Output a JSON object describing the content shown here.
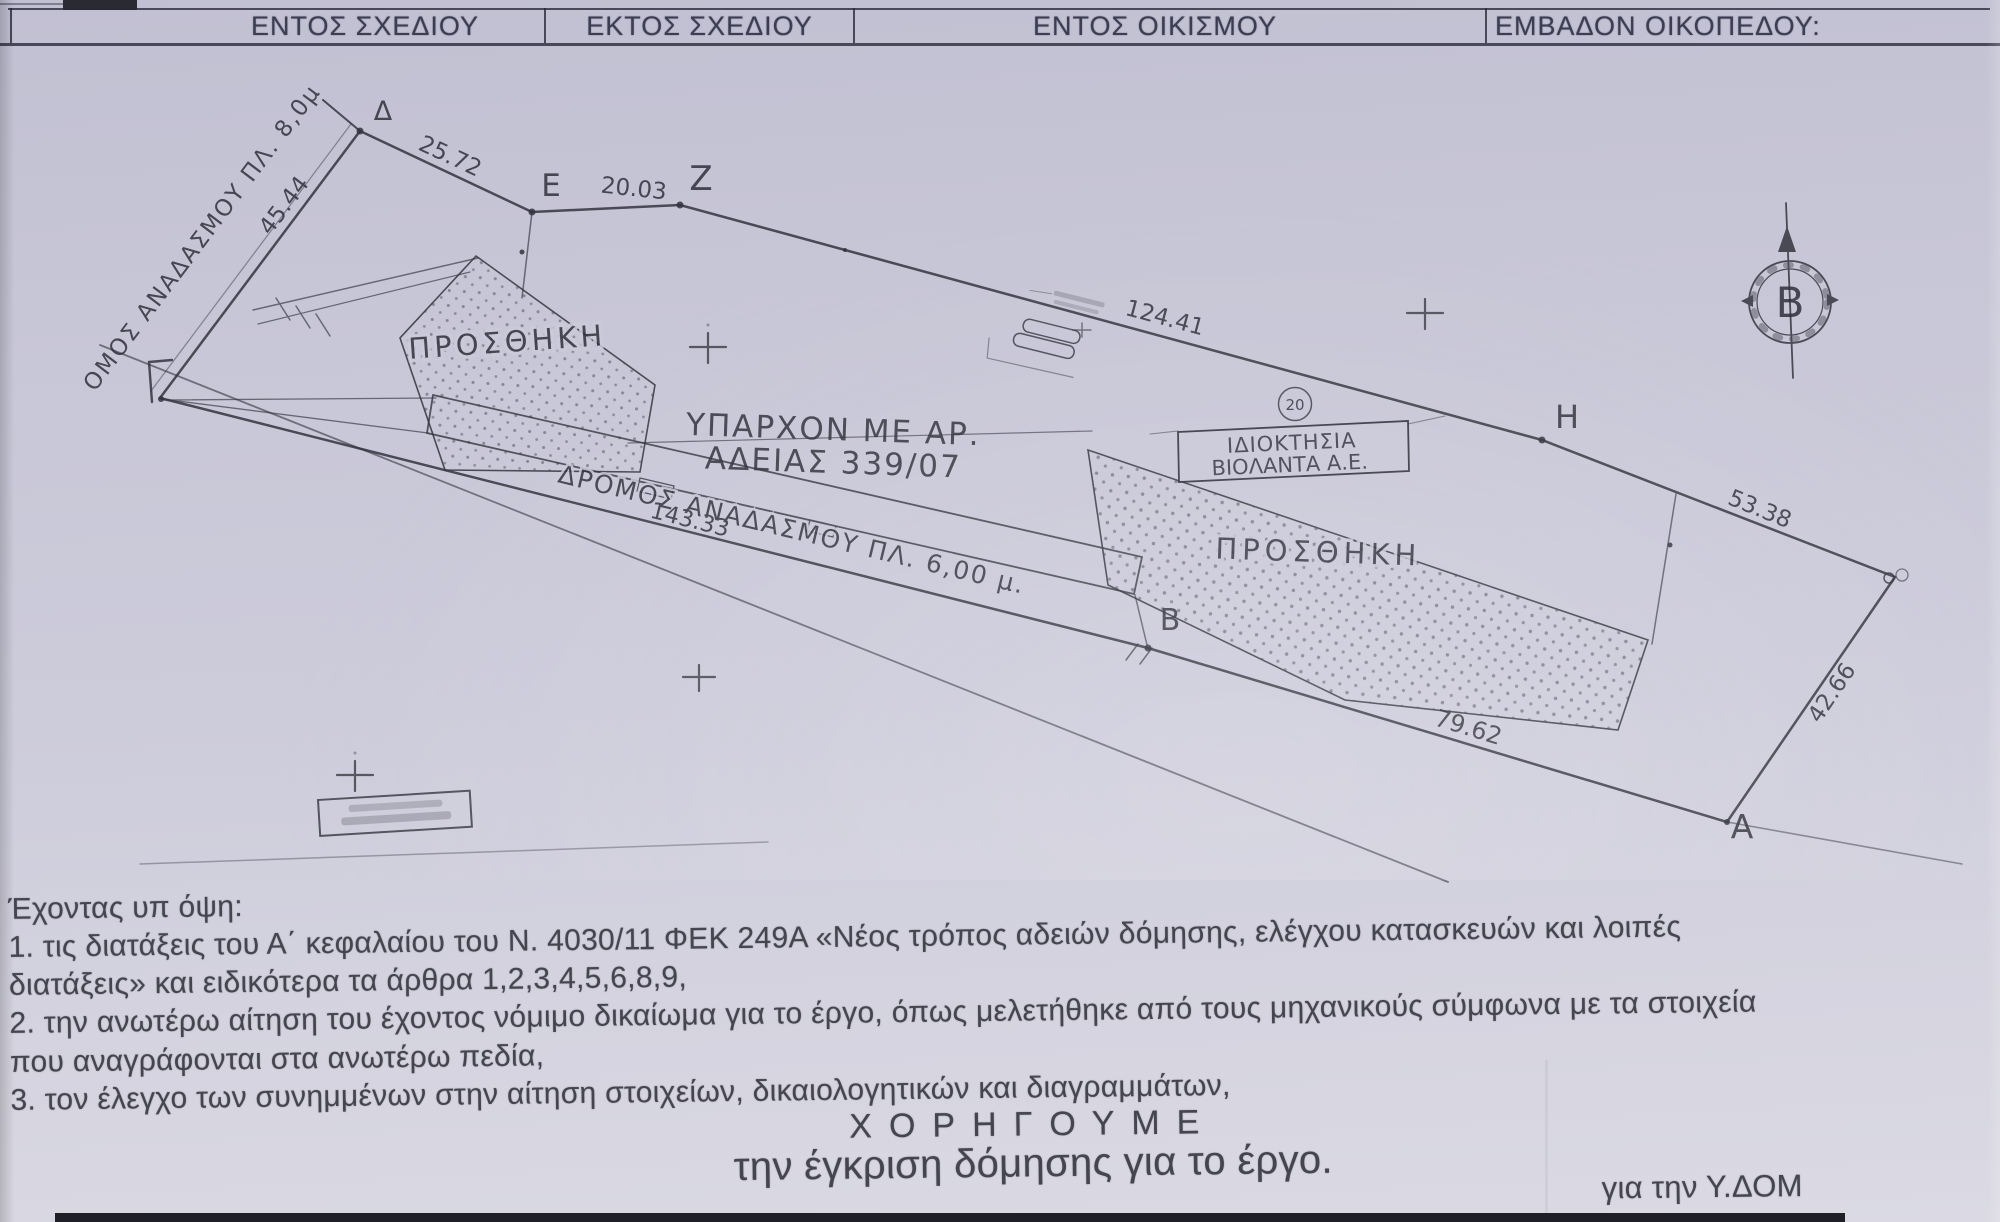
{
  "header": {
    "cells": [
      {
        "label": "ΕΝΤΟΣ ΣΧΕΔΙΟΥ"
      },
      {
        "label": "ΕΚΤΟΣ ΣΧΕΔΙΟΥ"
      },
      {
        "label": "ΕΝΤΟΣ ΟΙΚΙΣΜΟΥ"
      },
      {
        "label": "ΕΜΒΑΔΟΝ ΟΙΚΟΠΕΔΟΥ:"
      }
    ]
  },
  "plan": {
    "annotations": {
      "addition_left": "ΠΡΟΣΘΗΚΗ",
      "addition_right": "ΠΡΟΣΘΗΚΗ",
      "existing_building_line1": "ΥΠΑΡΧΟΝ ΜΕ ΑΡ.",
      "existing_building_line2": "ΑΔΕΙΑΣ 339/07",
      "ownership_box_line1": "ΙΔΙΟΚΤΗΣΙΑ",
      "ownership_box_line2": "ΒΙΟΛΑΝΤΑ Α.Ε.",
      "parcel_number": "20",
      "road_bottom": "ΔΡΟΜΟΣ ΑΝΑΔΑΣΜΟΥ ΠΛ. 6,00 μ.",
      "road_left": "ΟΜΟΣ ΑΝΑΔΑΣΜΟΥ ΠΛ. 8,0μ",
      "north_letter": "Β"
    },
    "points": {
      "delta": "Δ",
      "epsilon": "Ε",
      "zeta": "Ζ",
      "eta": "Η",
      "beta": "Β",
      "alpha": "Α"
    },
    "dimensions": {
      "gamma_delta": "45.44",
      "delta_epsilon": "25.72",
      "epsilon_zeta": "20.03",
      "zeta_eta": "124.41",
      "gamma_beta": "143.33",
      "beta_alpha": "79.62",
      "eta_theta": "53.38",
      "theta_alpha": "42.66"
    }
  },
  "body": {
    "intro": "Έχοντας υπ όψη:",
    "items": [
      {
        "text": "1. τις διατάξεις του Α΄ κεφαλαίου του Ν. 4030/11 ΦΕΚ 249Α «Νέος τρόπος αδειών δόμησης, ελέγχου κατασκευών και λοιπές"
      },
      {
        "text": "διατάξεις» και ειδικότερα τα άρθρα 1,2,3,4,5,6,8,9,"
      },
      {
        "text": "2. την ανωτέρω αίτηση του έχοντος νόμιμο δικαίωμα για το έργο, όπως μελετήθηκε από τους μηχανικούς σύμφωνα με τα στοιχεία"
      },
      {
        "text": "που αναγράφονται στα ανωτέρω πεδία,"
      },
      {
        "text": "3. τον έλεγχο των συνημμένων στην αίτηση στοιχείων, δικαιολογητικών και διαγραμμάτων,"
      }
    ],
    "grant_heading": "ΧΟΡΗΓΟΥΜΕ",
    "grant_text": "την έγκριση δόμησης για το έργο.",
    "signature_note": "για την Υ.ΔΟΜ"
  },
  "colors": {
    "paper": "#c9c8d8",
    "ink": "#34343f"
  }
}
